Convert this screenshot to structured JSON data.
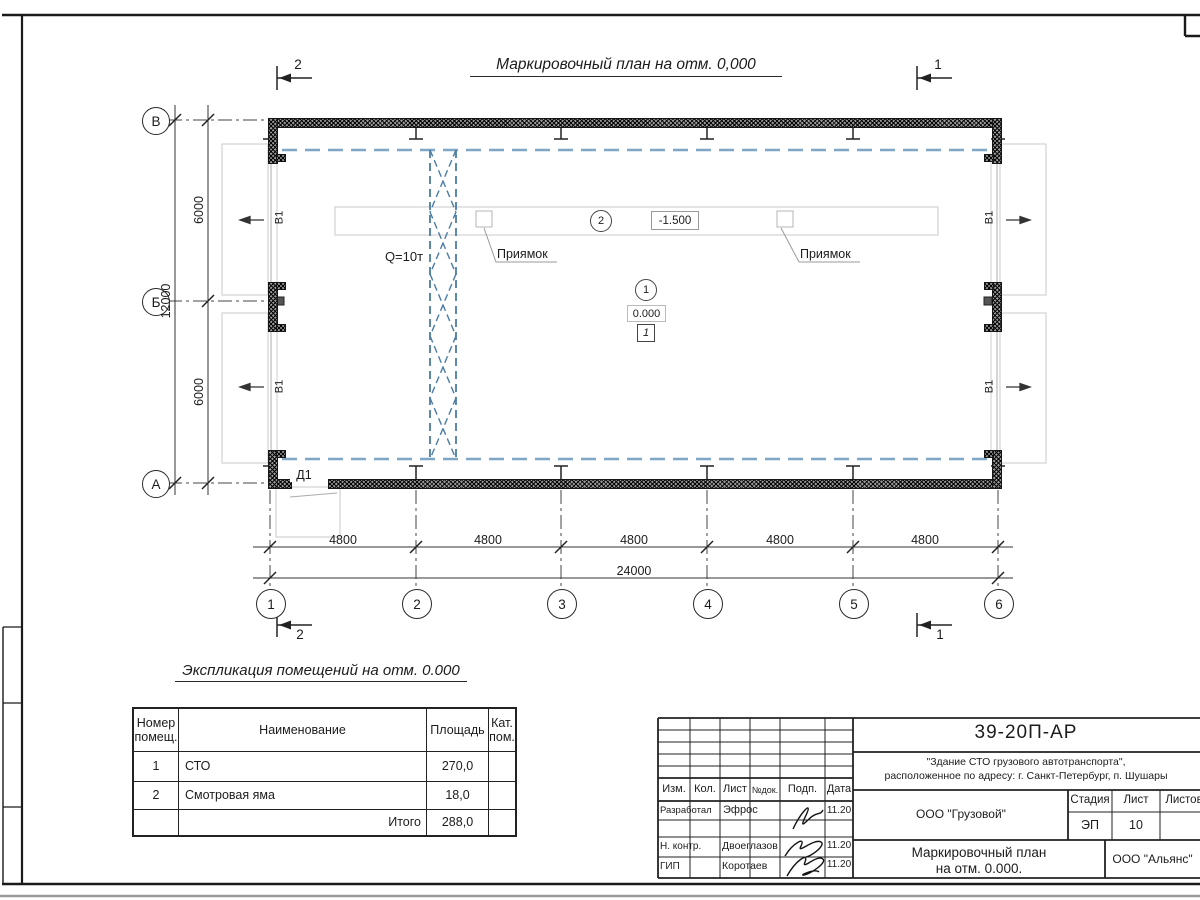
{
  "plan": {
    "title": "Маркировочный план на отм. 0,000",
    "crane_capacity": "Q=10т",
    "pit_callout": "Приямок",
    "pit_elevation": "-1.500",
    "floor_elevation": "0.000",
    "floor_type_mark": "1",
    "room_mark_1": "1",
    "room_mark_2": "2",
    "gate_mark": "В1",
    "door_mark": "Д1",
    "section_mark_1": "1",
    "section_mark_2": "2",
    "axes": {
      "h": [
        "1",
        "2",
        "3",
        "4",
        "5",
        "6"
      ],
      "v": [
        "В",
        "Б",
        "А"
      ]
    },
    "dims": {
      "bays": [
        "4800",
        "4800",
        "4800",
        "4800",
        "4800"
      ],
      "total_width": "24000",
      "spans": [
        "6000",
        "6000"
      ],
      "total_depth": "12000"
    }
  },
  "explication": {
    "title": "Экспликация помещений на отм. 0.000",
    "headers": [
      "Номер\nпомещ.",
      "Наименование",
      "Площадь",
      "Кат.\nпом."
    ],
    "rows": [
      {
        "num": "1",
        "name": "СТО",
        "area": "270,0",
        "cat": ""
      },
      {
        "num": "2",
        "name": "Смотровая яма",
        "area": "18,0",
        "cat": ""
      }
    ],
    "total_label": "Итого",
    "total_area": "288,0"
  },
  "stamp": {
    "doc_number": "39-20П-АР",
    "description_line1": "\"Здание СТО грузового автотранспорта\",",
    "description_line2": "расположенное по адресу: г. Санкт-Петербург, п. Шушары",
    "header_cols": [
      "Изм.",
      "Кол.",
      "Лист",
      "№док.",
      "Подп.",
      "Дата"
    ],
    "row_developed_label": "Разработал",
    "row_developed_name": "Эфрос",
    "row_developed_date": "11.20",
    "row_ncontrol_label": "Н. контр.",
    "row_ncontrol_name": "Двоеглазов",
    "row_ncontrol_date": "11.20",
    "row_gip_label": "ГИП",
    "row_gip_name": "Коротаев",
    "row_gip_date": "11.20",
    "customer": "ООО \"Грузовой\"",
    "stage_label": "Стадия",
    "stage_value": "ЭП",
    "sheet_label": "Лист",
    "sheet_value": "10",
    "sheets_label": "Листов",
    "drawing_title_line1": "Маркировочный план",
    "drawing_title_line2": "на отм. 0.000.",
    "contractor": "ООО \"Альянс\""
  }
}
